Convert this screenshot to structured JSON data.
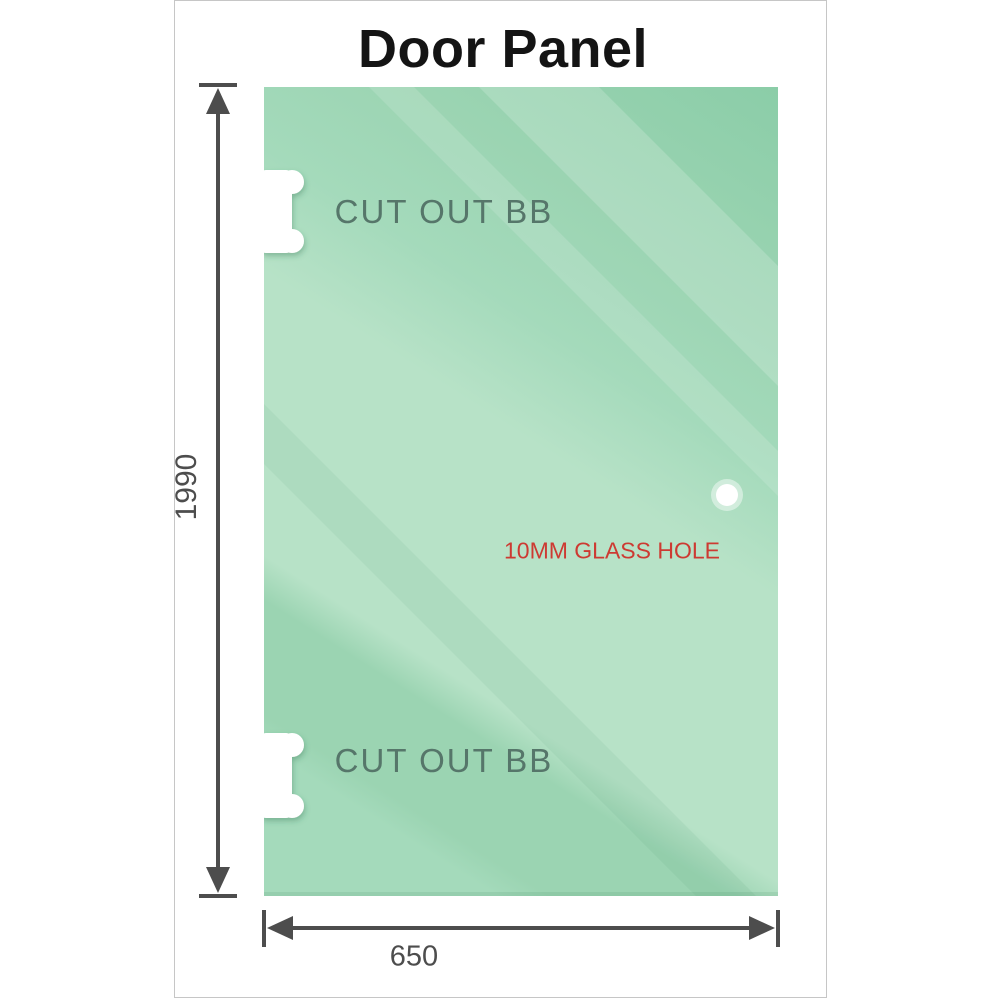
{
  "title": "Door Panel",
  "panel": {
    "cutout_top": {
      "label": "CUT OUT BB"
    },
    "cutout_bottom": {
      "label": "CUT OUT BB"
    },
    "glass_hole": {
      "label": "10MM GLASS HOLE"
    }
  },
  "dimensions": {
    "height_label": "1990",
    "width_label": "650"
  },
  "colors": {
    "glass_dark": "#8bcda8",
    "glass_band": "#9bd4b2",
    "glass_mid": "#a4dabb",
    "glass_light": "#b7e2c7",
    "dimension": "#4d4d4d",
    "cutout_text": "#56766a",
    "hole_text": "#cd3a32",
    "frame_border": "#c6c6c6",
    "title_text": "#141414"
  }
}
